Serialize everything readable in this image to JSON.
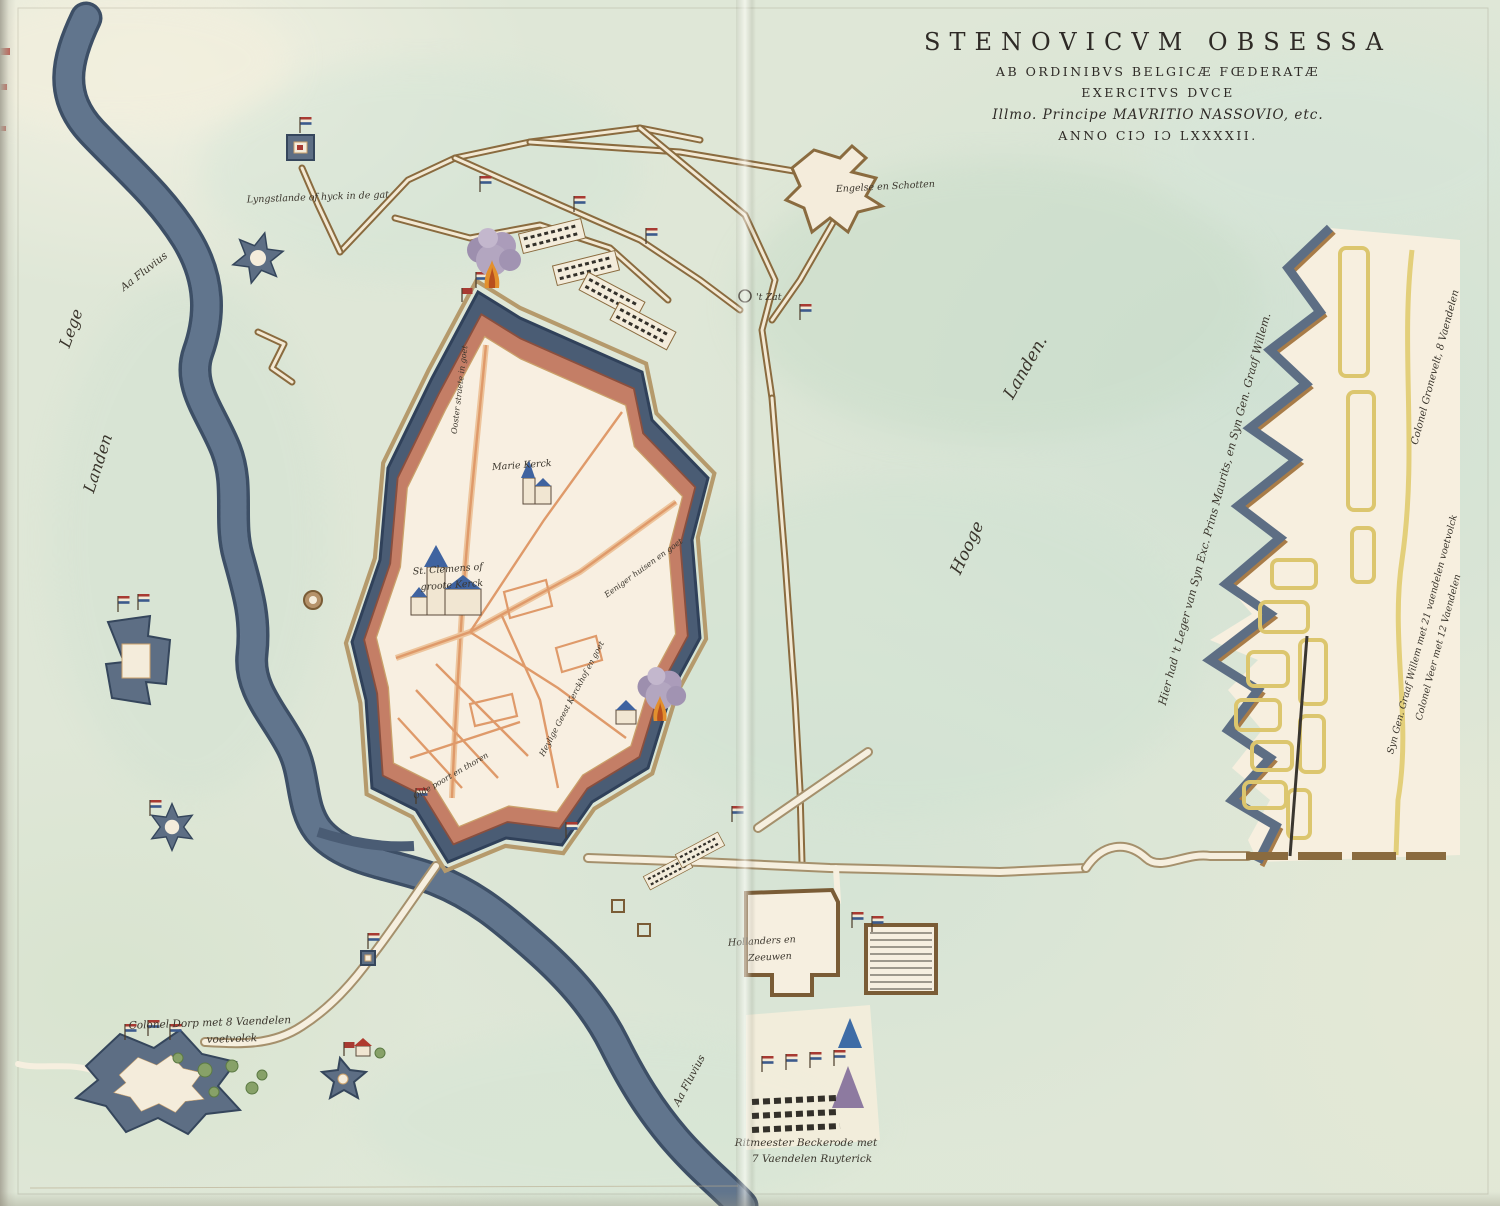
{
  "title": {
    "line1": "STENOVICVM OBSESSA",
    "line2": "AB ORDINIBVS BELGICÆ FŒDERATÆ",
    "line3": "EXERCITVS DVCE",
    "line4": "Illmo. Principe MAVRITIO NASSOVIO, etc.",
    "line5": "ANNO CIƆ IƆ LXXXXII."
  },
  "geography": {
    "river_label_upper": "Aa Fluvius",
    "river_label_lower": "Aa Fluvius",
    "lege": "Lege",
    "landen_west": "Landen",
    "hooge": "Hooge",
    "landen_east": "Landen."
  },
  "city": {
    "marie_kerck": "Marie Kerck",
    "st_clemens_line1": "St. Clemens of",
    "st_clemens_line2": "groote Kerck",
    "street_north": "Ooster straete in goet",
    "street_east": "Eeniger huisen en goet",
    "street_south": "Heylige Geest Kerckhof en goet",
    "gate_south": "Olde poort en thoren"
  },
  "siege": {
    "north_label": "Lyngstlande of hyck in de gat",
    "english_scots": "Engelse en Schotten",
    "t_zat": "'t Zat",
    "hollanders_line1": "Hollanders en",
    "hollanders_line2": "Zeeuwen",
    "colonel_dorp_line1": "Colonel Dorp met 8 Vaendelen",
    "colonel_dorp_line2": "voetvolck",
    "ritmeester_line1": "Ritmeester Beckerode met",
    "ritmeester_line2": "7 Vaendelen Ruyterick"
  },
  "camp": {
    "leger_label": "Hier had 't Leger van Syn Exc. Prins Maurits, en Syn Gen. Graaf Willem.",
    "gronevelt": "Colonel Gronevelt, 8 Vaendelen",
    "graaf_willem": "Syn Gen. Graaf Willem met 21 vaendelen voetvolck",
    "veer": "Colonel Veer met 12 Vaendelen"
  },
  "palette": {
    "paper": "#dfe7d7",
    "paper_cream": "#f2efdd",
    "river_blue": "#71849c",
    "moat_blue": "#4a5c74",
    "wall_red": "#c47e66",
    "city_interior": "#f8efe1",
    "street_orange": "#df9a6a",
    "trench_brown": "#8a6b3f",
    "camp_yellow": "#dcc66e",
    "fort_slate": "#5d6e84",
    "smoke_purple": "#ab9cba",
    "flame_orange": "#e2902e",
    "flag_red": "#a83a32",
    "flag_blue": "#3c5a8c",
    "ink": "#3a352c"
  }
}
